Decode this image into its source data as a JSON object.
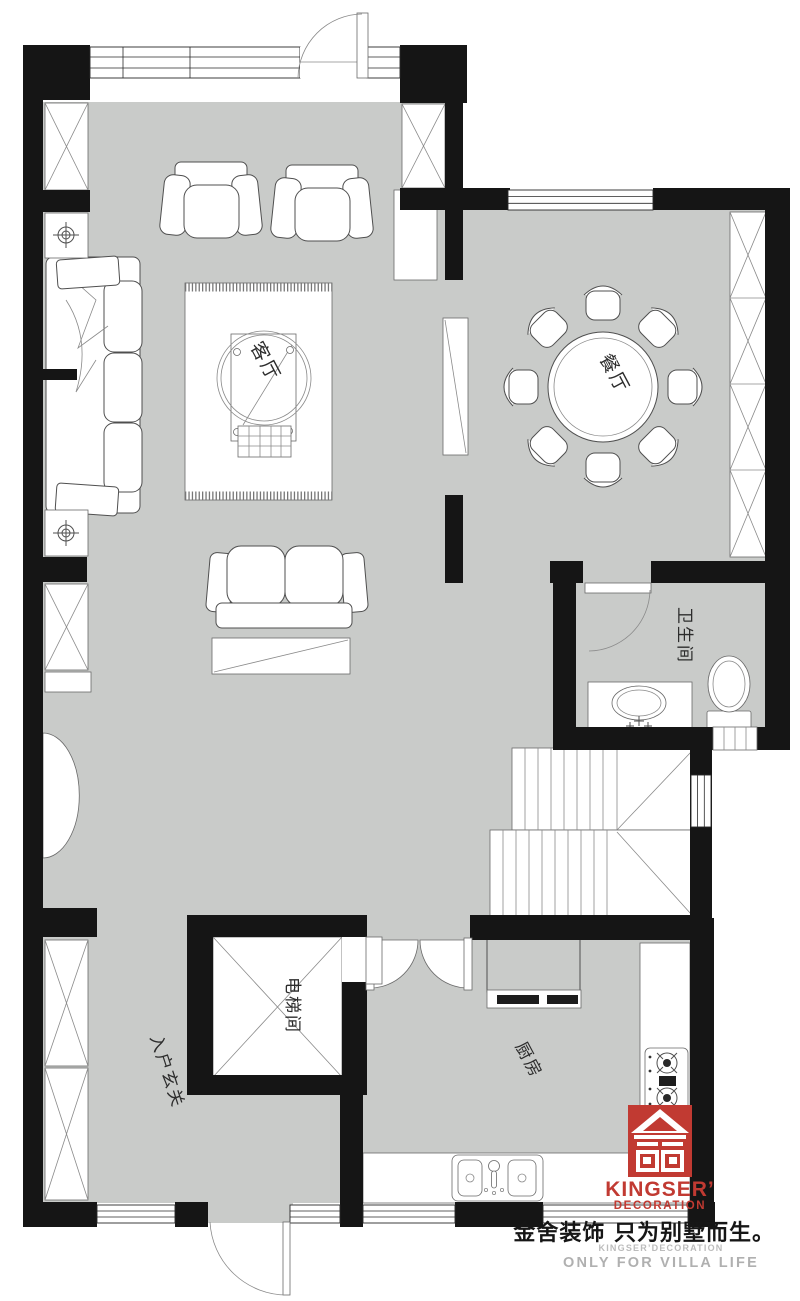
{
  "rooms": {
    "living_room": "客厅",
    "dining_room": "餐厅",
    "bathroom": "卫生间",
    "elevator_room": "电梯间",
    "entrance_hall": "入户玄关",
    "kitchen": "厨房"
  },
  "logo": {
    "brand": "KINGSER’",
    "brand_sub": "DECORATION",
    "slogan_cn": "金舍装饰 只为别墅而生。",
    "slogan_en_small": "KINGSER’DECORATION",
    "slogan_en": "ONLY FOR VILLA LIFE"
  },
  "colors": {
    "floor_fill": "#c9cbc9",
    "wall_fill": "#151515",
    "brand_red": "#c13a32"
  }
}
